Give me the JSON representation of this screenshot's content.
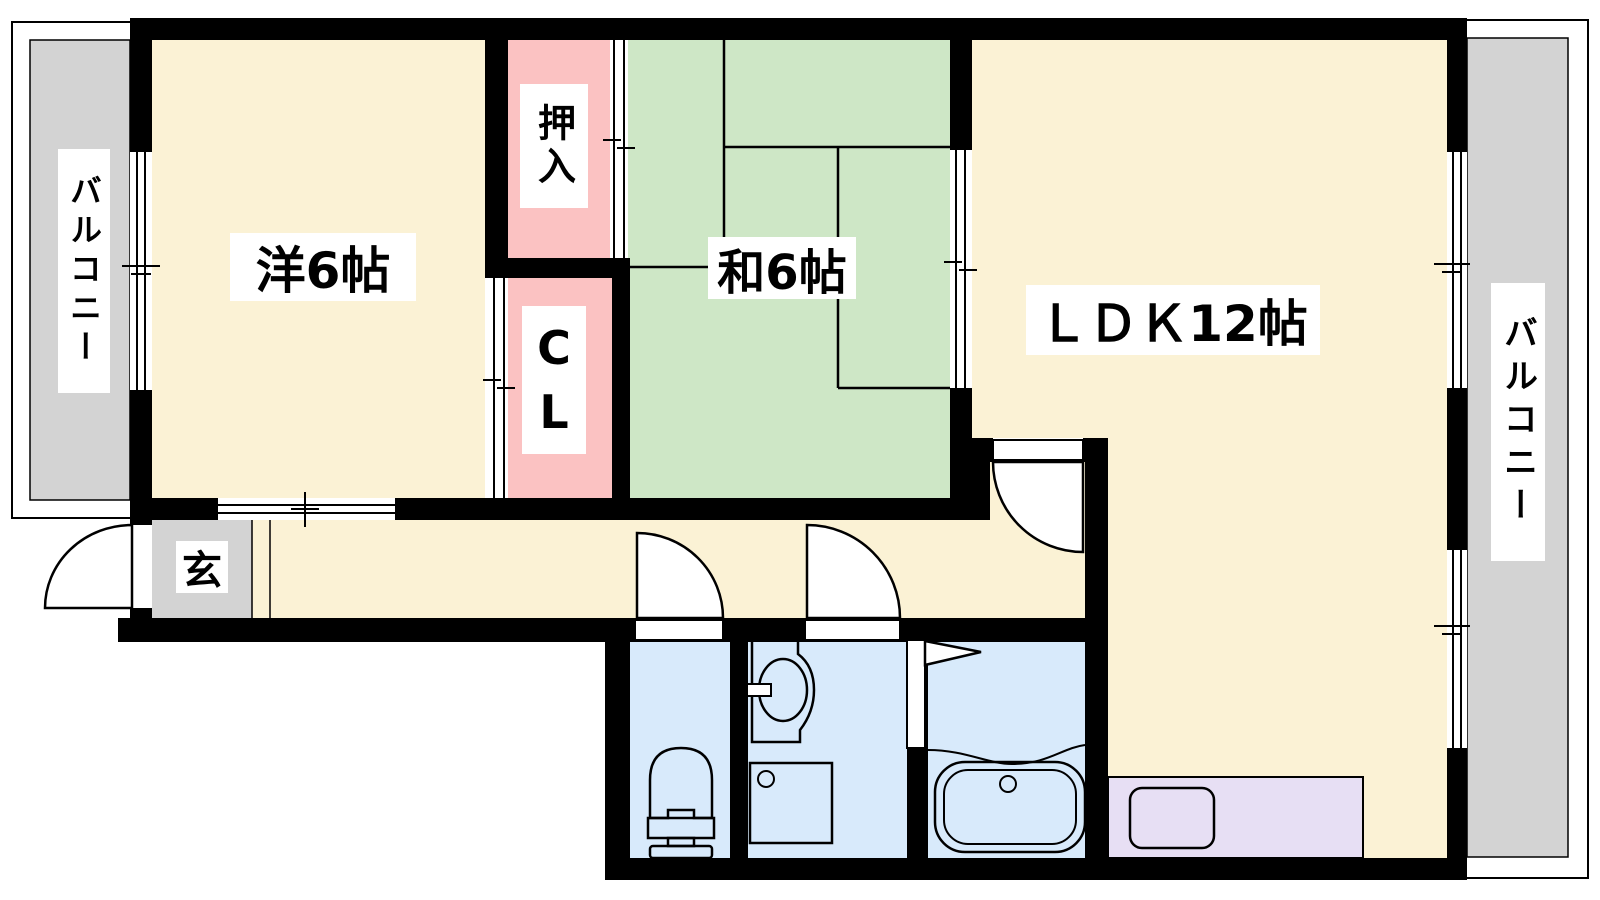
{
  "floorplan": {
    "type": "apartment-floor-plan",
    "labels": {
      "west_room": "洋6帖",
      "japanese_room": "和6帖",
      "ldk": "ＬＤＫ12帖",
      "oshiire": "押入",
      "closet": "C\nL",
      "genkan": "玄",
      "balcony_left": "バルコニー",
      "balcony_right": "バルコニー"
    },
    "colors": {
      "wall": "#000000",
      "line": "#000000",
      "room_cream": "#FBF2D5",
      "tatami_green": "#CEE7C6",
      "closet_pink": "#FBC2C2",
      "wet_area_blue": "#D8EAFB",
      "kitchen_lavender": "#E7DFF4",
      "balcony_gray": "#D3D3D3",
      "label_background": "#FFFFFF"
    },
    "fixtures": [
      "toilet",
      "vanity-sink",
      "washing-machine-pan",
      "bathtub",
      "kitchen-sink"
    ]
  }
}
